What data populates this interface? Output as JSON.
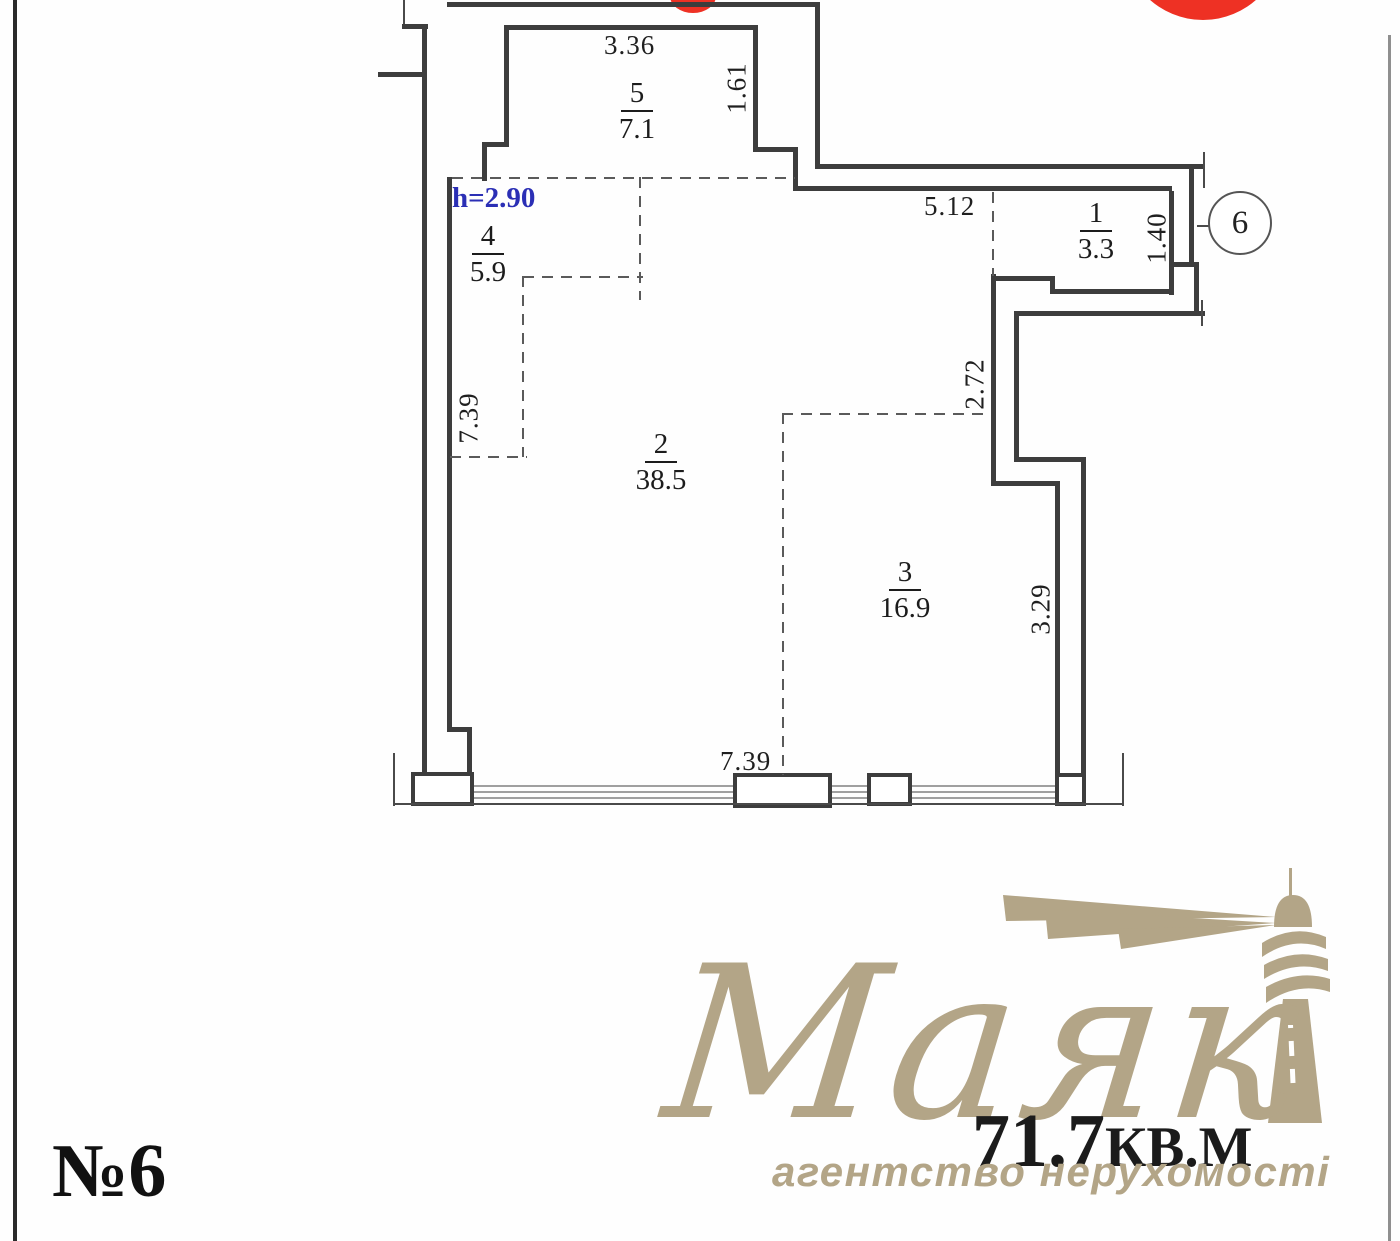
{
  "plan": {
    "unit_label": "№6",
    "ceiling_height_note": "h=2.90",
    "rooms": [
      {
        "num": "5",
        "area": "7.1"
      },
      {
        "num": "4",
        "area": "5.9"
      },
      {
        "num": "2",
        "area": "38.5"
      },
      {
        "num": "3",
        "area": "16.9"
      },
      {
        "num": "1",
        "area": "3.3"
      }
    ],
    "dimensions": {
      "top": "3.36",
      "room5_right": "1.61",
      "corridor": "5.12",
      "entry": "1.40",
      "mid_right": "2.72",
      "right": "3.29",
      "left": "7.39",
      "bottom": "7.39"
    },
    "stairwell_label": "6"
  },
  "watermark": {
    "brand": "Маяк",
    "area_value": "71.7",
    "area_unit": "кв.м",
    "tagline": "агентство нерухомості"
  },
  "colors": {
    "wall": "#3d3d3d",
    "dashed_partition": "#5a5a5a",
    "marker_red": "#ee3124",
    "height_note_blue": "#2b2fb5",
    "watermark_beige": "#b3a587",
    "area_text_black": "#1b1b1b"
  }
}
